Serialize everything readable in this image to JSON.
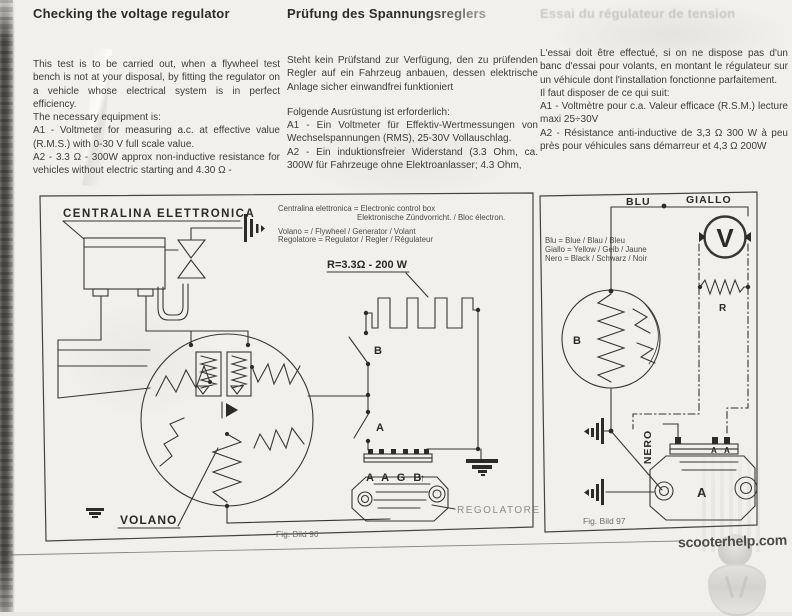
{
  "page": {
    "heading_en": "Checking the voltage regulator",
    "heading_de": "Prüfung des Spannungsreglers",
    "heading_fr": "Essai du régulateur de tension",
    "body_en": [
      "This test is to be carried out, when a flywheel test bench is not at your disposal, by fitting the regulator on a vehicle whose electrical system is in perfect efficiency.",
      "The necessary equipment is:",
      "A1 - Voltmeter for measuring a.c. at effective value (R.M.S.) with 0-30 V full scale value.",
      "A2 - 3.3 Ω - 300W approx non-inductive resistance for vehicles without electric starting and 4.30 Ω -"
    ],
    "body_de": [
      "Steht kein Prüfstand zur Verfügung, den zu prüfenden Regler auf ein Fahrzeug anbauen, dessen elektrische Anlage sicher einwandfrei funktioniert",
      "Folgende Ausrüstung ist erforderlich:",
      "A1 - Ein Voltmeter für Effektiv-Wertmessungen von Wechselspannungen (RMS), 25-30V Vollauschlag.",
      "A2 - Ein induktionsfreier Widerstand (3.3 Ohm, ca. 300W für Fahrzeuge ohne Elektroanlasser; 4.3 Ohm,"
    ],
    "body_fr": [
      "L'essai doit être effectué, si on ne dispose pas d'un banc d'essai pour volants, en montant le régulateur sur un véhicule dont l'installation fonctionne parfaitement.",
      "Il faut disposer de ce qui suit:",
      "A1 - Voltmètre pour c.a. Valeur efficace (R.S.M.) lecture maxi 25÷30V",
      "A2 - Résistance anti-inductive de 3,3 Ω 300 W à peu près pour véhicules sans démarreur et 4,3 Ω 200W"
    ]
  },
  "fig96": {
    "caption": "Fig. Bild 96",
    "label_centralina": "CENTRALINA ELETTRONICA",
    "label_volano": "VOLANO",
    "label_regolatore": "REGOLATORE",
    "label_resistor": "R=3.3Ω - 200 W",
    "label_switch_b": "B",
    "label_switch_a": "A",
    "label_terminals": "A A G B",
    "terminal_arrow": "↑",
    "legend": [
      "Centralina elettronica = Electronic control box",
      "Elektronische Zündvorricht. / Bloc électron.",
      "Volano = / Flywheel / Generator / Volant",
      "Regolatore = Regulator / Regler / Régulateur"
    ]
  },
  "fig97": {
    "caption": "Fig. Bild 97",
    "label_blu": "BLU",
    "label_giallo": "GIALLO",
    "label_nero": "NERO",
    "label_flywheel": "B",
    "label_resistor": "R",
    "label_regulator": "A",
    "label_terminal_1": "A",
    "label_terminal_2": "A",
    "voltmeter_symbol": "V",
    "legend": [
      "Blu = Blue / Blau / Bleu",
      "Giallo = Yellow / Gelb / Jaune",
      "Nero = Black / Schwarz / Noir"
    ]
  },
  "watermark": {
    "site": "scooterhelp.com"
  }
}
